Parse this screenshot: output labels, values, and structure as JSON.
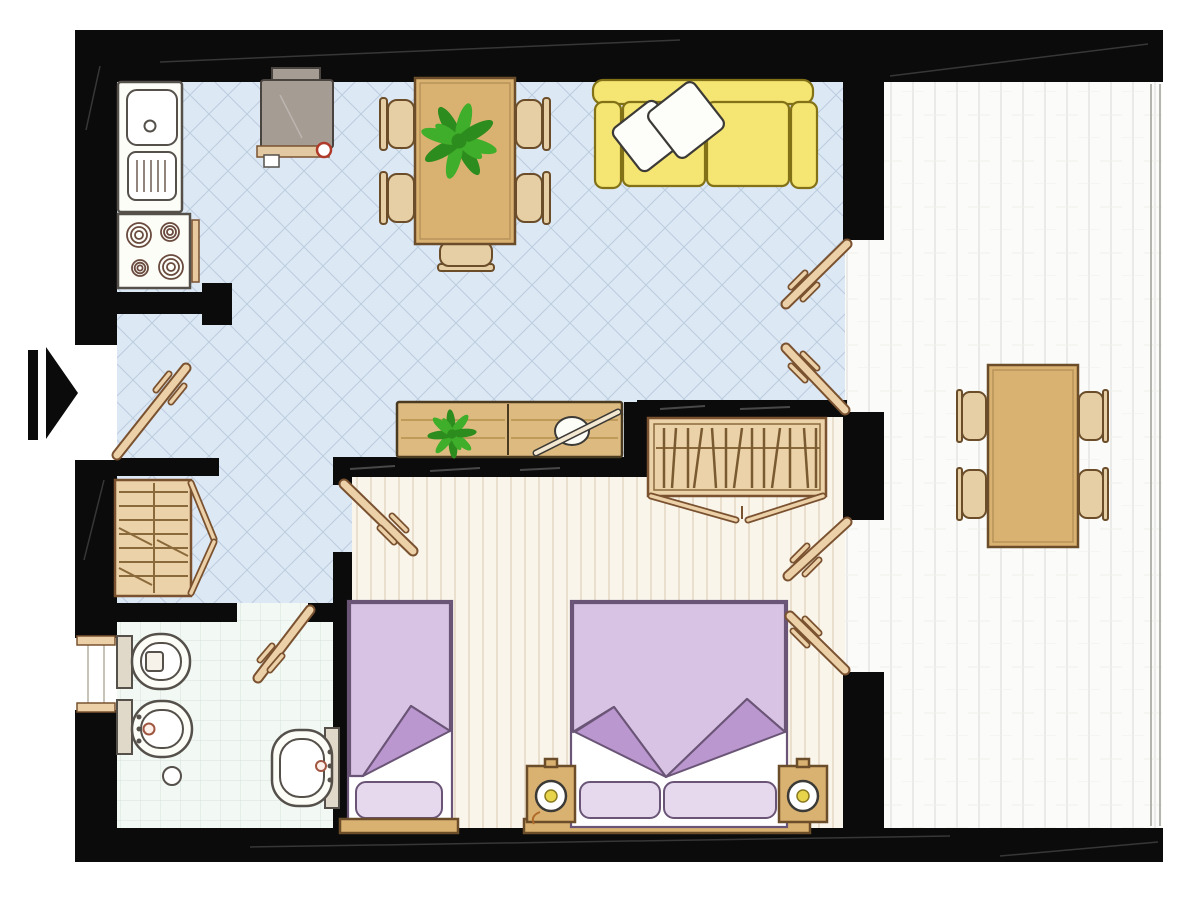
{
  "title": "apartment-floor-plan",
  "colors": {
    "wall": "#0b0b0b",
    "blue_floor": "#dce8f4",
    "blue_grid": "#bccddf",
    "cream_floor": "#faf5eb",
    "cream_stripe": "#eadfcd",
    "terrace_floor": "#fbfbf9",
    "terrace_line": "#e4e4e0",
    "bath_floor": "#f2f8f4",
    "bath_grid": "#d6e4da",
    "wood": "#d9b271",
    "wood_dark": "#6b4d2a",
    "wood_light": "#e6cfa5",
    "sideboard": "#ddbb80",
    "wardrobe": "#ecd2a8",
    "door_leaf": "#ecd0a8",
    "door_outline": "#7a5230",
    "sofa": "#f5e573",
    "sofa_outline": "#827117",
    "white": "#fdfdfa",
    "outline_dark": "#3c3a36",
    "bed_purple": "#d9c3e4",
    "bed_fold": "#bb97cf",
    "bed_outline": "#6b5577",
    "bed_pillow": "#e6d9ee",
    "fixture": "#fdfdf8",
    "fixture_outline": "#55504a",
    "fixture_beige": "#e0d8c8",
    "plant": "#3fae2a",
    "plant_dark": "#2d8c1e",
    "tv_gray": "#a59c94",
    "tv_outline": "#4a4440",
    "lamp_yellow": "#e8d44a",
    "accent_red": "#b03a2a",
    "railing": "#b5b5af"
  },
  "plan": {
    "type": "apartment-floor-plan-top-view",
    "rooms": [
      {
        "id": "kitchen",
        "floor": "tile-blue-diagonal"
      },
      {
        "id": "living-dining",
        "floor": "tile-blue-diagonal"
      },
      {
        "id": "hallway",
        "floor": "tile-blue-diagonal"
      },
      {
        "id": "bathroom",
        "floor": "tile-white-grid"
      },
      {
        "id": "bedroom",
        "floor": "plank-cream"
      },
      {
        "id": "terrace",
        "floor": "plank-white"
      }
    ],
    "furniture": {
      "kitchen": [
        "sink-counter",
        "dish-drainer",
        "stove-four-burners",
        "oven-handle"
      ],
      "living_dining": [
        "tv-unit",
        "dining-table",
        "dining-chairs-x5",
        "potted-plant",
        "sofa",
        "throw-pillows-x2",
        "sideboard",
        "decor-bowl",
        "potted-plant-small"
      ],
      "hallway": [
        "shelved-wardrobe",
        "entrance-door",
        "entrance-arrow"
      ],
      "bathroom": [
        "toilet",
        "bidet",
        "washbasin",
        "floor-drain",
        "window",
        "bathroom-door"
      ],
      "bedroom": [
        "single-bed",
        "double-bed",
        "nightstands-x2",
        "table-lamps-x2",
        "hanging-wardrobe",
        "bedroom-door"
      ],
      "terrace": [
        "outdoor-table",
        "outdoor-chairs-x4",
        "french-doors-living",
        "french-doors-bedroom",
        "railing"
      ]
    }
  }
}
